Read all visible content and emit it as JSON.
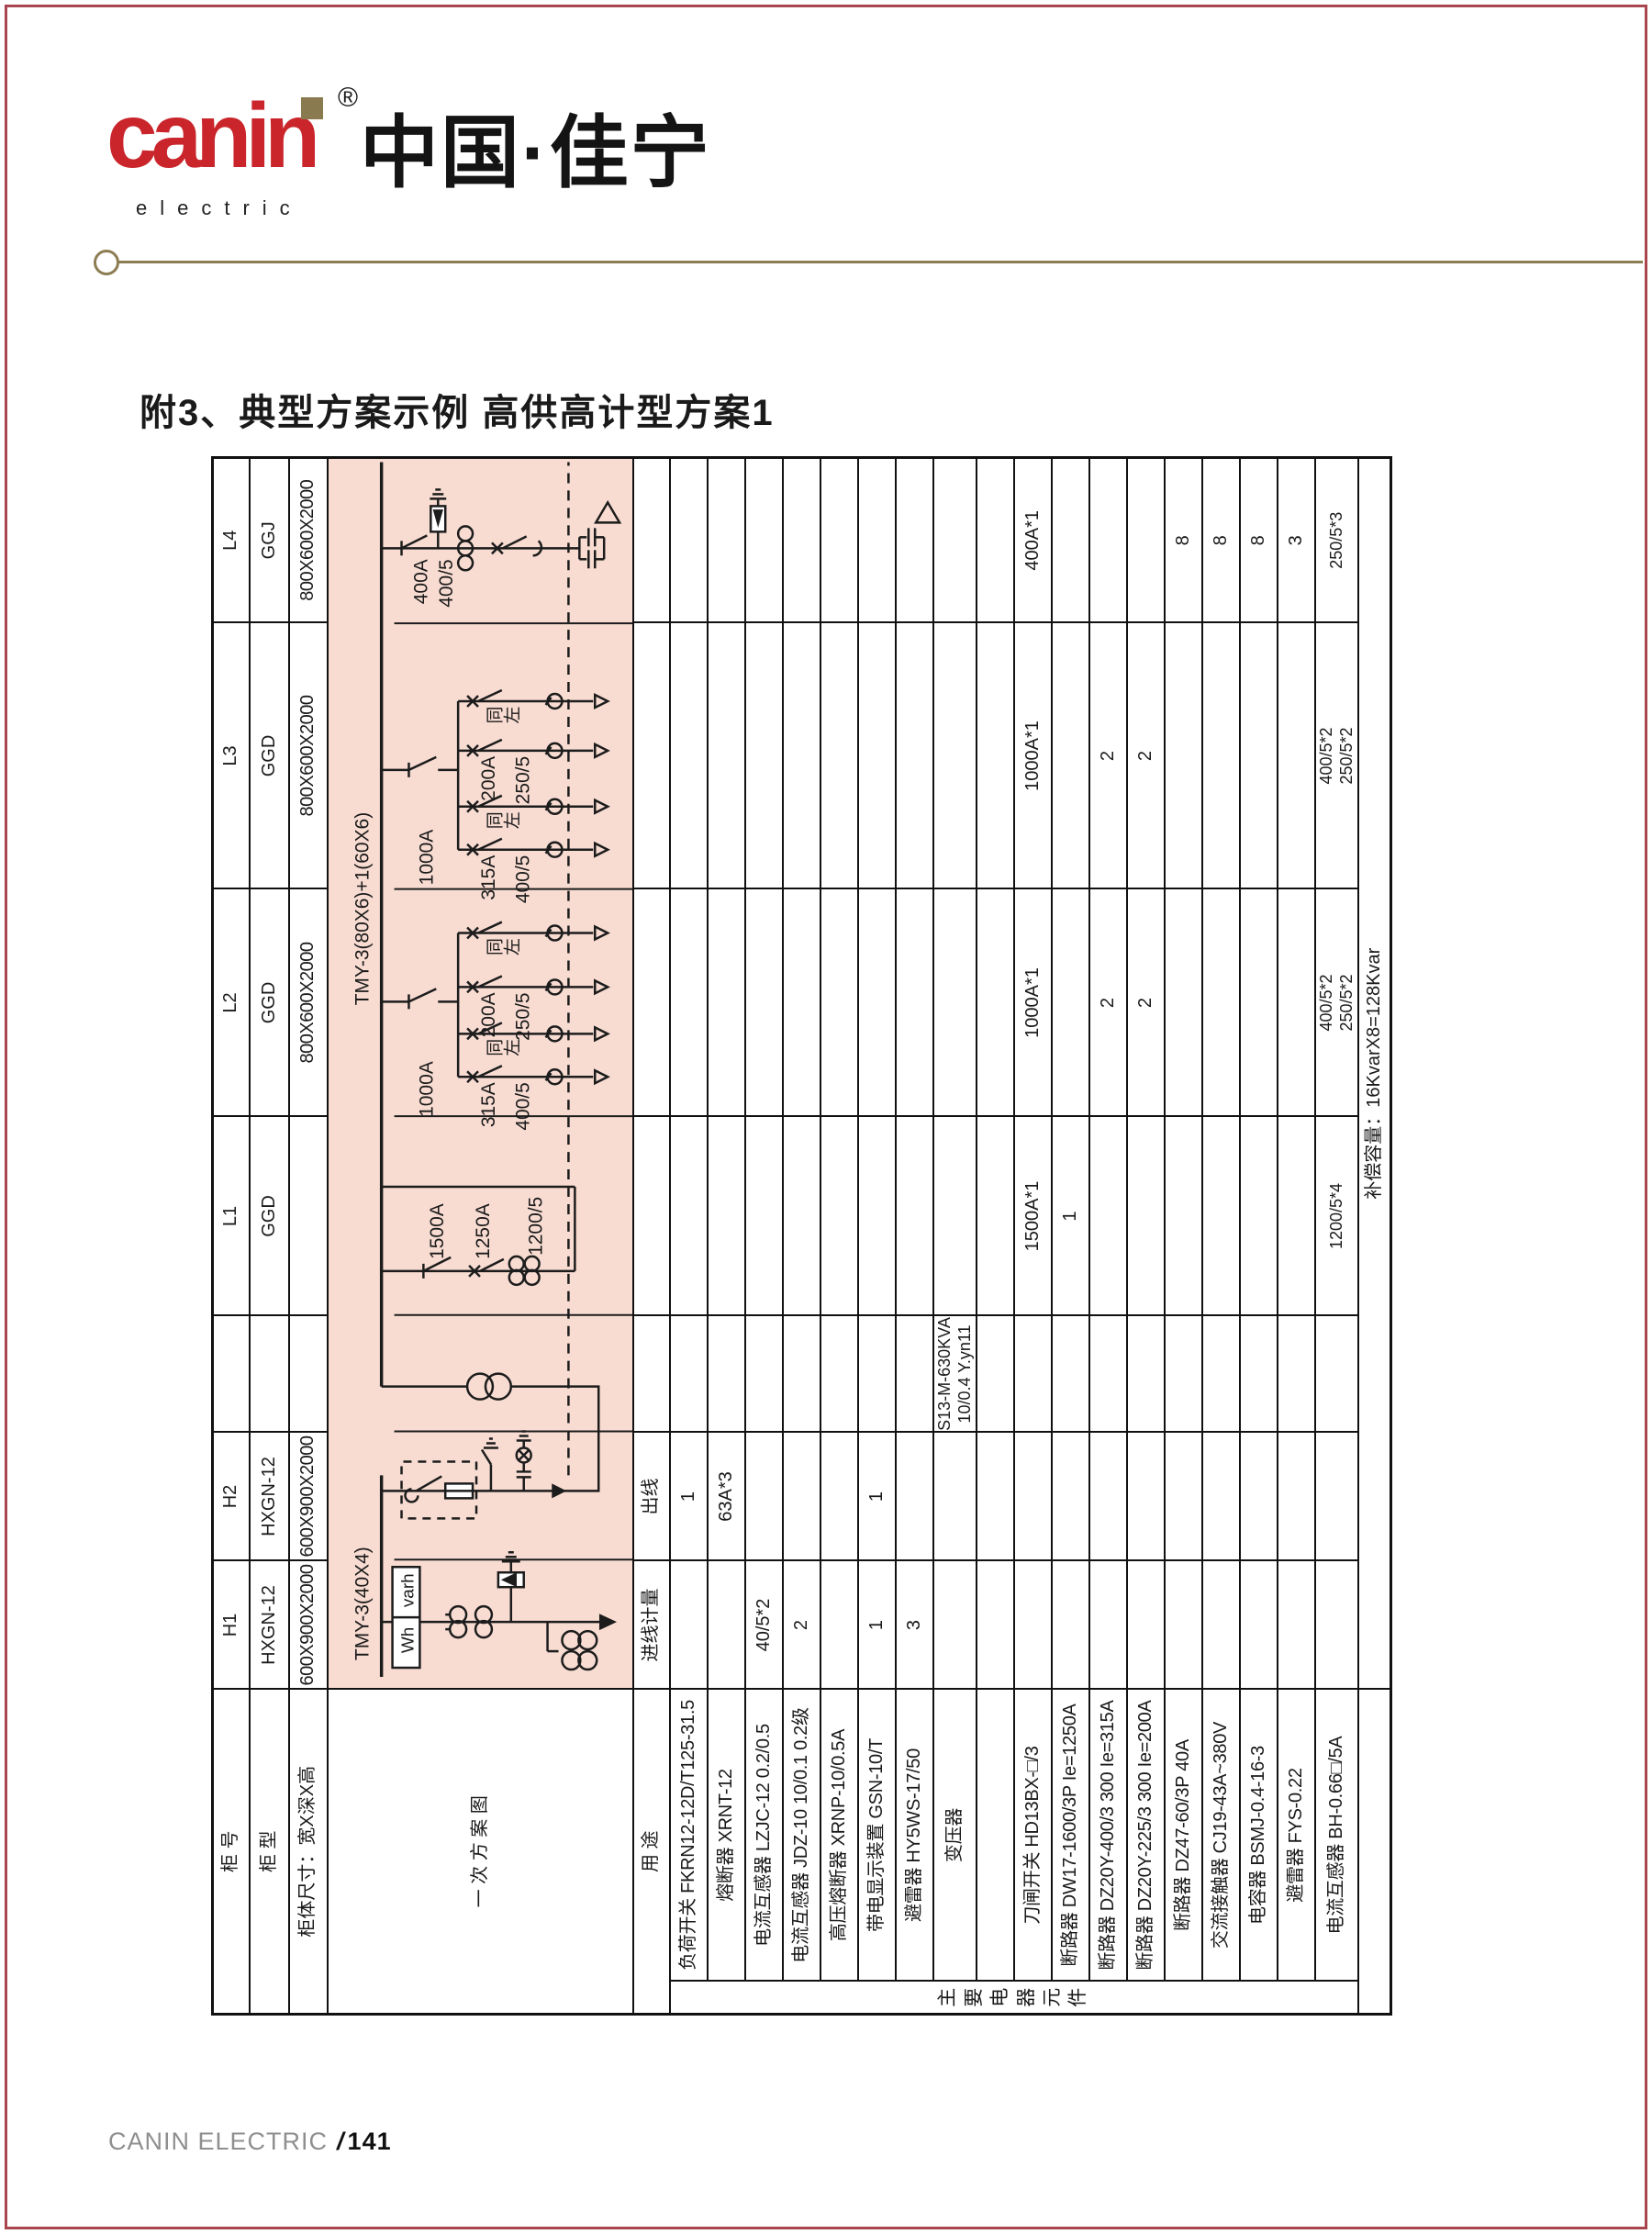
{
  "header": {
    "logo": "canin",
    "logo_reg": "®",
    "logo_sub": "electric",
    "brand_cn": "中国·佳宁",
    "title": "附3、典型方案示例 高供高计型方案1"
  },
  "footer": {
    "brand": "CANIN ELECTRIC",
    "separator": "/",
    "page_no": "141"
  },
  "table": {
    "labels": {
      "cabinet_no": "柜 号",
      "cabinet_type": "柜 型",
      "cabinet_size": "柜体尺寸：宽X深X高",
      "scheme": "一 次 方 案 图",
      "usage": "用 途",
      "group": "主要电器元件"
    },
    "header_rows": [
      {
        "values": [
          "H1",
          "H2",
          "",
          "L1",
          "L2",
          "L3",
          "L4"
        ]
      },
      {
        "values": [
          "HXGN-12",
          "HXGN-12",
          "",
          "GGD",
          "GGD",
          "GGD",
          "GGJ"
        ]
      },
      {
        "values": [
          "600X900X2000",
          "600X900X2000",
          "",
          "",
          "800X600X2000",
          "800X600X2000",
          "800X600X2000"
        ]
      }
    ],
    "usage_row": {
      "values": [
        "进线计量",
        "出线",
        "",
        "",
        "",
        "",
        ""
      ]
    },
    "components": [
      {
        "name": "负荷开关  FKRN12-12D/T125-31.5",
        "values": [
          "",
          "1",
          "",
          "",
          "",
          "",
          ""
        ]
      },
      {
        "name": "熔断器  XRNT-12",
        "values": [
          "",
          "63A*3",
          "",
          "",
          "",
          "",
          ""
        ]
      },
      {
        "name": "电流互感器  LZJC-12 0.2/0.5",
        "values": [
          "40/5*2",
          "",
          "",
          "",
          "",
          "",
          ""
        ]
      },
      {
        "name": "电流互感器  JDZ-10 10/0.1 0.2级",
        "values": [
          "2",
          "",
          "",
          "",
          "",
          "",
          ""
        ]
      },
      {
        "name": "高压熔断器  XRNP-10/0.5A",
        "values": [
          "",
          "",
          "",
          "",
          "",
          "",
          ""
        ]
      },
      {
        "name": "带电显示装置  GSN-10/T",
        "values": [
          "1",
          "1",
          "",
          "",
          "",
          "",
          ""
        ]
      },
      {
        "name": "避雷器  HY5WS-17/50",
        "values": [
          "3",
          "",
          "",
          "",
          "",
          "",
          ""
        ]
      },
      {
        "name": "变压器",
        "values": [
          "",
          "",
          "S13-M-630KVA\n10/0.4 Y.yn11",
          "",
          "",
          "",
          ""
        ]
      },
      {
        "name": "",
        "values": [
          "",
          "",
          "",
          "",
          "",
          "",
          ""
        ]
      },
      {
        "name": "刀闸开关  HD13BX-□/3",
        "values": [
          "",
          "",
          "",
          "1500A*1",
          "1000A*1",
          "1000A*1",
          "400A*1"
        ]
      },
      {
        "name": "断路器  DW17-1600/3P Ie=1250A",
        "values": [
          "",
          "",
          "",
          "1",
          "",
          "",
          ""
        ]
      },
      {
        "name": "断路器  DZ20Y-400/3 300 Ie=315A",
        "values": [
          "",
          "",
          "",
          "",
          "2",
          "2",
          ""
        ]
      },
      {
        "name": "断路器  DZ20Y-225/3 300 Ie=200A",
        "values": [
          "",
          "",
          "",
          "",
          "2",
          "2",
          ""
        ]
      },
      {
        "name": "断路器  DZ47-60/3P 40A",
        "values": [
          "",
          "",
          "",
          "",
          "",
          "",
          "8"
        ]
      },
      {
        "name": "交流接触器  CJ19-43A~380V",
        "values": [
          "",
          "",
          "",
          "",
          "",
          "",
          "8"
        ]
      },
      {
        "name": "电容器  BSMJ-0.4-16-3",
        "values": [
          "",
          "",
          "",
          "",
          "",
          "",
          "8"
        ]
      },
      {
        "name": "避雷器  FYS-0.22",
        "values": [
          "",
          "",
          "",
          "",
          "",
          "",
          "3"
        ]
      },
      {
        "name": "电流互感器  BH-0.66□/5A",
        "values": [
          "",
          "",
          "",
          "1200/5*4",
          "400/5*2\n250/5*2",
          "400/5*2\n250/5*2",
          "250/5*3"
        ]
      }
    ],
    "note_row": {
      "text": "补偿容量：16KvarX8=128Kvar"
    }
  },
  "diagram": {
    "bg_color": "#f8dcd2",
    "busbar_hv": "TMY-3(40X4)",
    "busbar_lv": "TMY-3(80X6)+1(60X6)",
    "meter_wh": "Wh",
    "meter_varh": "varh",
    "l1_knife": "1500A",
    "l1_breaker": "1250A",
    "l1_ct": "1200/5",
    "feeder_knife": "1000A",
    "feeder_b1_breaker": "315A",
    "feeder_b1_ct": "400/5",
    "feeder_same1": "同左",
    "feeder_b3_breaker": "200A",
    "feeder_b3_ct": "250/5",
    "feeder_same2": "同左",
    "l4_knife": "400A",
    "l4_ct": "400/5"
  }
}
